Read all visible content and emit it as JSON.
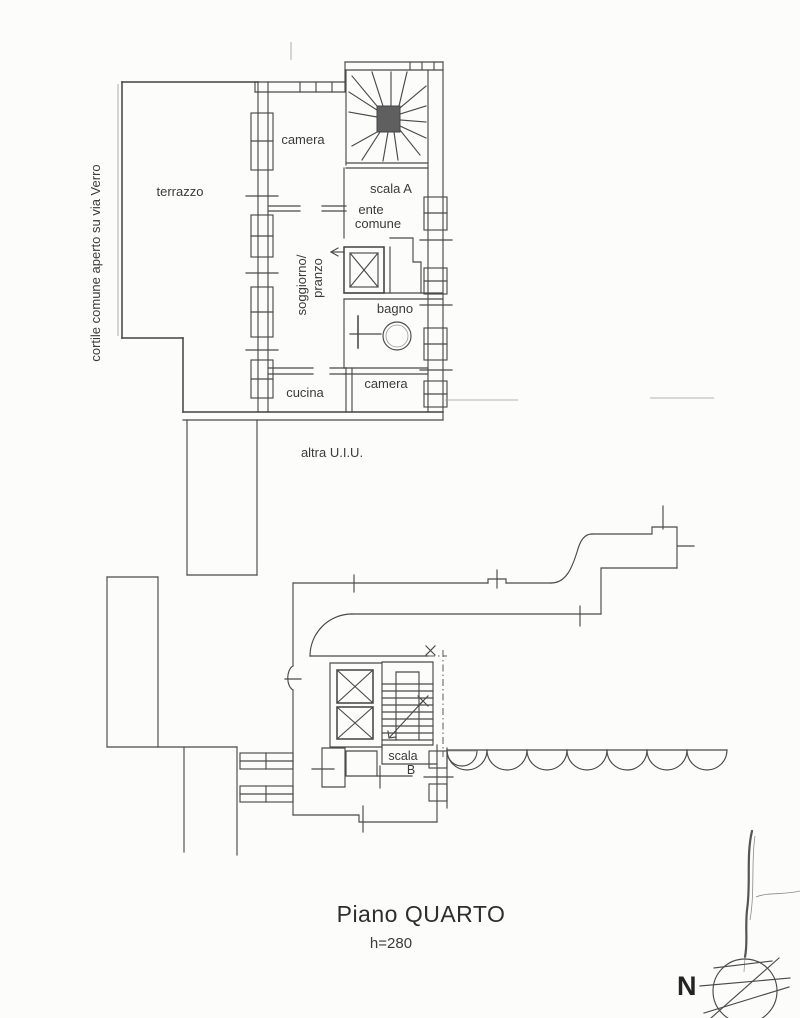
{
  "document": {
    "background": "#fcfcfb",
    "ink_color": "#4a4a4a",
    "text_color": "#3b3b3b"
  },
  "upper_plan": {
    "courtyard_label": "cortile comune aperto su via Verro",
    "rooms": {
      "terrazzo": "terrazzo",
      "camera_top": "camera",
      "scala_a": "scala A",
      "ente_line1": "ente",
      "ente_line2": "comune",
      "soggiorno_line1": "soggiorno/",
      "soggiorno_line2": "pranzo",
      "bagno": "bagno",
      "cucina": "cucina",
      "camera_bottom": "camera"
    },
    "other_unit_note": "altra U.I.U."
  },
  "lower_plan": {
    "rooms": {
      "scala_b_line1": "scala",
      "scala_b_line2": "B"
    }
  },
  "caption": {
    "floor_title": "Piano QUARTO",
    "ceiling_height": "h=280"
  },
  "compass": {
    "north": "N"
  }
}
